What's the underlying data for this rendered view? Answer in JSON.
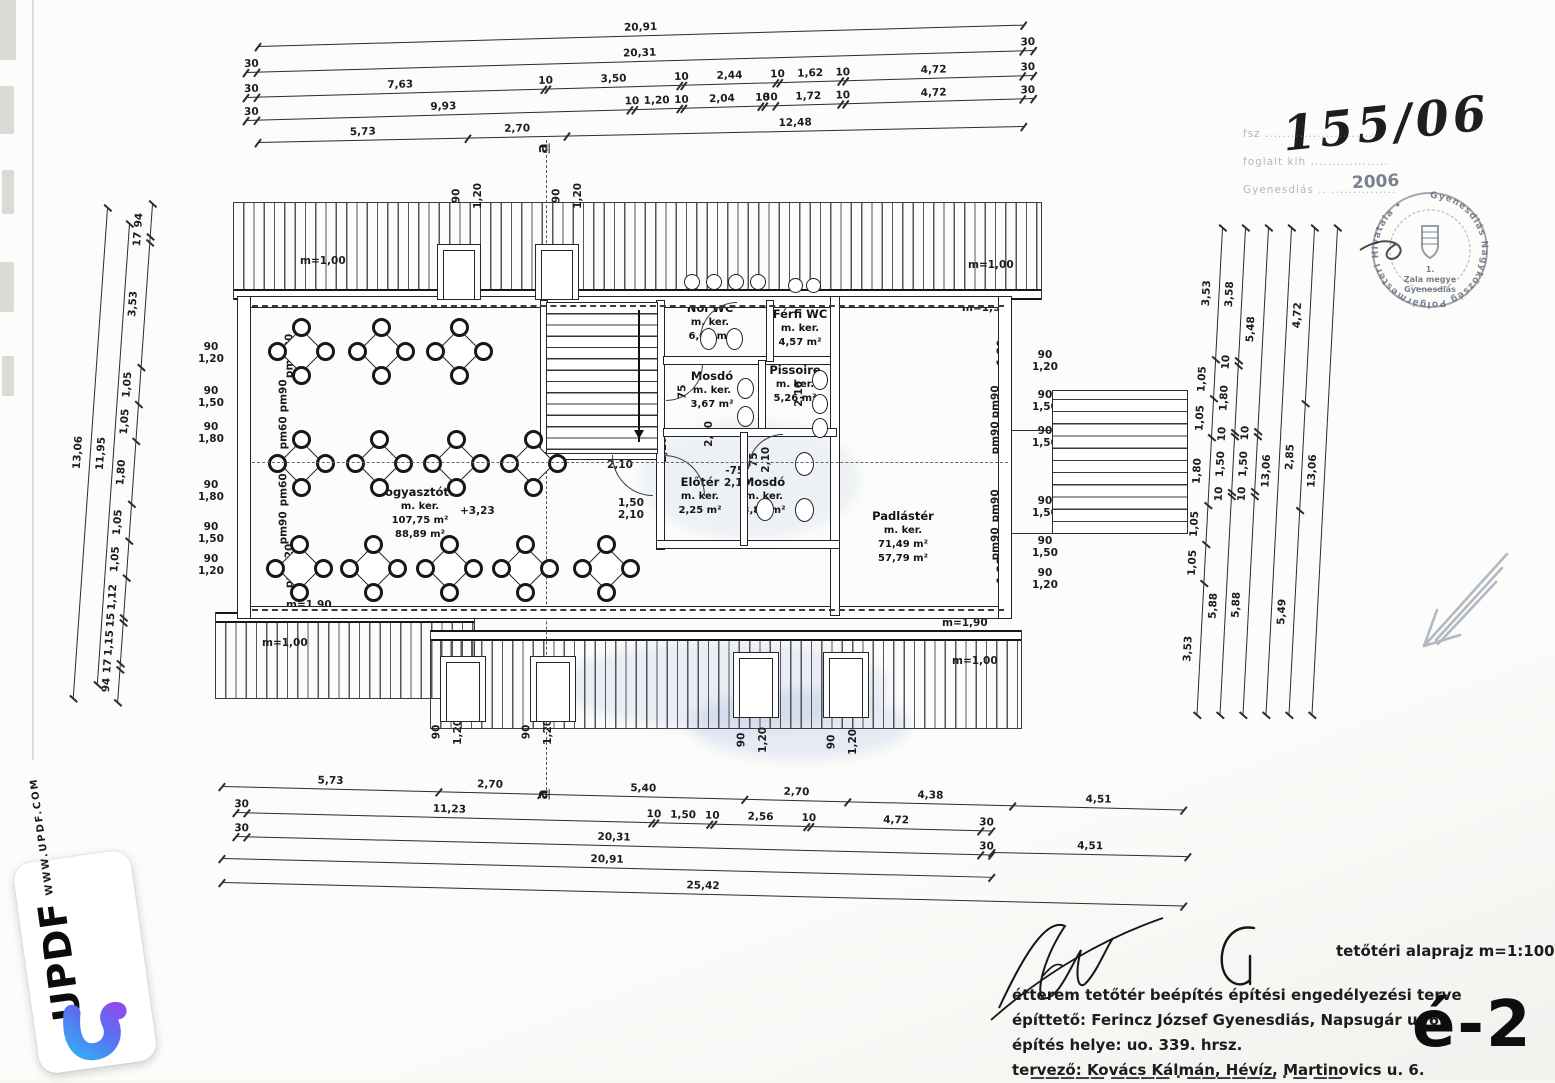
{
  "stamp": {
    "number": "155/06",
    "year": "2006",
    "ring_text": "Gyenesdiás Nagyközség Polgármesteri Hivatala •",
    "center_lines": [
      "1.",
      "Zala megye",
      "Gyenesdiás"
    ],
    "faint_lines": [
      "fsz ..........................",
      "foglalt kih ..................",
      "Gyenesdiás .. ..............."
    ]
  },
  "title_block": {
    "drawing_title": "tetőtéri alaprajz m=1:100",
    "project_lines": [
      "étterem tetőtér beépítés építési engedélyezési terve",
      "építtető: Ferincz József Gyenesdiás, Napsugár u. 6.",
      "építés helye: uo. 339. hrsz.",
      "tervező: Kovács Kálmán, Hévíz, Martinovics u. 6."
    ],
    "truncated_line": "—————  ————  · ——————  ·  — ——",
    "drawing_code": "é-2"
  },
  "watermark": {
    "brand": "UPDF",
    "url": "WWW.UPDF.COM"
  },
  "rooms": [
    {
      "x": 420,
      "y": 484,
      "lines": [
        "Fogyasztótér",
        "m. ker.",
        "107,75 m²",
        "88,89 m²"
      ]
    },
    {
      "x": 710,
      "y": 300,
      "lines": [
        "Női WC",
        "m. ker.",
        "6,07 m²"
      ]
    },
    {
      "x": 800,
      "y": 306,
      "lines": [
        "Férfi WC",
        "m. ker.",
        "4,57 m²"
      ]
    },
    {
      "x": 712,
      "y": 368,
      "lines": [
        "Mosdó",
        "m. ker.",
        "3,67 m²"
      ]
    },
    {
      "x": 795,
      "y": 362,
      "lines": [
        "Pissoire",
        "m. ker.",
        "5,26 m²"
      ]
    },
    {
      "x": 700,
      "y": 474,
      "lines": [
        "Előtér",
        "m. ker.",
        "2,25 m²"
      ]
    },
    {
      "x": 764,
      "y": 474,
      "lines": [
        "Mosdó",
        "m. ker.",
        "3,84 m²"
      ]
    },
    {
      "x": 903,
      "y": 508,
      "lines": [
        "Padlástér",
        "m. ker.",
        "71,49 m²",
        "57,79 m²"
      ]
    }
  ],
  "chains": [
    {
      "x": 258,
      "y": 46,
      "len": 766,
      "rot": -1.6,
      "labels": [
        "20,91"
      ]
    },
    {
      "x": 246,
      "y": 72,
      "len": 788,
      "rot": -1.6,
      "labels": [
        "30",
        "20,31",
        "30"
      ]
    },
    {
      "x": 246,
      "y": 97,
      "len": 788,
      "rot": -1.6,
      "labels": [
        "30",
        "7,63",
        "10",
        "3,50",
        "10",
        "2,44",
        "10",
        "1,62",
        "10",
        "4,72",
        "30"
      ]
    },
    {
      "x": 246,
      "y": 120,
      "len": 788,
      "rot": -1.6,
      "labels": [
        "30",
        "9,93",
        "10",
        "1,20",
        "10",
        "2,04",
        "10",
        "30",
        "1,72",
        "10",
        "4,72",
        "30"
      ]
    },
    {
      "x": 258,
      "y": 142,
      "len": 766,
      "rot": -1.2,
      "labels": [
        "5,73",
        "2,70",
        "12,48"
      ]
    },
    {
      "x": 222,
      "y": 786,
      "len": 962,
      "rot": 1.4,
      "labels": [
        "5,73",
        "2,70",
        "5,40",
        "2,70",
        "4,38",
        "4,51"
      ]
    },
    {
      "x": 236,
      "y": 812,
      "len": 756,
      "rot": 1.4,
      "labels": [
        "30",
        "11,23",
        "10",
        "1,50",
        "10",
        "2,56",
        "10",
        "4,72",
        "30"
      ]
    },
    {
      "x": 236,
      "y": 836,
      "len": 756,
      "rot": 1.4,
      "labels": [
        "30",
        "20,31",
        "30"
      ]
    },
    {
      "x": 222,
      "y": 858,
      "len": 770,
      "rot": 1.4,
      "labels": [
        "20,91"
      ]
    },
    {
      "x": 992,
      "y": 852,
      "len": 196,
      "rot": 1.2,
      "labels": [
        "4,51"
      ]
    },
    {
      "x": 222,
      "y": 882,
      "len": 962,
      "rot": 1.4,
      "labels": [
        "25,42"
      ]
    },
    {
      "v": 1,
      "x": 107,
      "y": 208,
      "len": 492,
      "rot": 4,
      "labels": [
        "13,06"
      ]
    },
    {
      "v": 1,
      "x": 129,
      "y": 224,
      "len": 462,
      "rot": 4,
      "labels": [
        "11,95"
      ]
    },
    {
      "v": 1,
      "x": 152,
      "y": 204,
      "len": 500,
      "rot": 4,
      "labels": [
        "94",
        "17",
        "3,53",
        "1,05",
        "1,05",
        "1,80",
        "1,05",
        "1,05",
        "1,12",
        "15",
        "1,15",
        "17",
        "94"
      ]
    },
    {
      "v": 1,
      "x": 1222,
      "y": 228,
      "len": 488,
      "rot": 3,
      "labels": [
        "3,53",
        "1,05",
        "1,05",
        "1,80",
        "1,05",
        "1,05",
        "3,53"
      ]
    },
    {
      "v": 1,
      "x": 1245,
      "y": 228,
      "len": 488,
      "rot": 3,
      "labels": [
        "3,58",
        "10",
        "1,80",
        "10",
        "1,50",
        "10",
        "5,88"
      ]
    },
    {
      "v": 1,
      "x": 1268,
      "y": 228,
      "len": 488,
      "rot": 3,
      "labels": [
        "5,48",
        "10",
        "1,50",
        "10",
        "5,88"
      ]
    },
    {
      "v": 1,
      "x": 1291,
      "y": 228,
      "len": 488,
      "rot": 3,
      "labels": [
        "13,06"
      ]
    },
    {
      "v": 1,
      "x": 1314,
      "y": 228,
      "len": 488,
      "rot": 3,
      "labels": [
        "4,72",
        "2,85",
        "5,49"
      ]
    },
    {
      "v": 1,
      "x": 1337,
      "y": 228,
      "len": 488,
      "rot": 3,
      "labels": [
        "13,06"
      ]
    }
  ],
  "annotations": [
    {
      "x": 300,
      "y": 256,
      "lines": [
        "m=1,00"
      ]
    },
    {
      "x": 968,
      "y": 260,
      "lines": [
        "m=1,00"
      ]
    },
    {
      "x": 262,
      "y": 638,
      "lines": [
        "m=1,00"
      ]
    },
    {
      "x": 952,
      "y": 656,
      "lines": [
        "m=1,00"
      ]
    },
    {
      "x": 286,
      "y": 298,
      "lines": [
        "m=1,90"
      ]
    },
    {
      "x": 962,
      "y": 303,
      "lines": [
        "m=1,90"
      ]
    },
    {
      "x": 286,
      "y": 600,
      "lines": [
        "m=1,90"
      ]
    },
    {
      "x": 942,
      "y": 618,
      "lines": [
        "m=1,90"
      ]
    },
    {
      "x": 268,
      "y": 350,
      "rot": -90,
      "lines": [
        "pm1,20"
      ]
    },
    {
      "x": 268,
      "y": 390,
      "rot": -90,
      "lines": [
        "pm90"
      ]
    },
    {
      "x": 268,
      "y": 427,
      "rot": -90,
      "lines": [
        "pm60"
      ]
    },
    {
      "x": 268,
      "y": 484,
      "rot": -90,
      "lines": [
        "pm60"
      ]
    },
    {
      "x": 268,
      "y": 522,
      "rot": -90,
      "lines": [
        "pm90"
      ]
    },
    {
      "x": 268,
      "y": 560,
      "rot": -90,
      "lines": [
        "pm1,20"
      ]
    },
    {
      "x": 980,
      "y": 356,
      "rot": -90,
      "lines": [
        "pm1,20"
      ]
    },
    {
      "x": 980,
      "y": 396,
      "rot": -90,
      "lines": [
        "pm90"
      ]
    },
    {
      "x": 980,
      "y": 432,
      "rot": -90,
      "lines": [
        "pm90"
      ]
    },
    {
      "x": 980,
      "y": 500,
      "rot": -90,
      "lines": [
        "pm90"
      ]
    },
    {
      "x": 980,
      "y": 538,
      "rot": -90,
      "lines": [
        "pm90"
      ]
    },
    {
      "x": 980,
      "y": 574,
      "rot": -90,
      "lines": [
        "pm1,20"
      ]
    },
    {
      "x": 198,
      "y": 342,
      "lines": [
        "90",
        "1,20"
      ]
    },
    {
      "x": 198,
      "y": 386,
      "lines": [
        "90",
        "1,50"
      ]
    },
    {
      "x": 198,
      "y": 422,
      "lines": [
        "90",
        "1,80"
      ]
    },
    {
      "x": 198,
      "y": 480,
      "lines": [
        "90",
        "1,80"
      ]
    },
    {
      "x": 198,
      "y": 522,
      "lines": [
        "90",
        "1,50"
      ]
    },
    {
      "x": 198,
      "y": 554,
      "lines": [
        "90",
        "1,20"
      ]
    },
    {
      "x": 1032,
      "y": 350,
      "lines": [
        "90",
        "1,20"
      ]
    },
    {
      "x": 1032,
      "y": 390,
      "lines": [
        "90",
        "1,50"
      ]
    },
    {
      "x": 1032,
      "y": 426,
      "lines": [
        "90",
        "1,50"
      ]
    },
    {
      "x": 1032,
      "y": 496,
      "lines": [
        "90",
        "1,50"
      ]
    },
    {
      "x": 1032,
      "y": 536,
      "lines": [
        "90",
        "1,50"
      ]
    },
    {
      "x": 1032,
      "y": 568,
      "lines": [
        "90",
        "1,20"
      ]
    },
    {
      "x": 450,
      "y": 190,
      "rot": -90,
      "lines": [
        "90"
      ]
    },
    {
      "x": 466,
      "y": 190,
      "rot": -90,
      "lines": [
        "1,20"
      ]
    },
    {
      "x": 550,
      "y": 190,
      "rot": -90,
      "lines": [
        "90"
      ]
    },
    {
      "x": 566,
      "y": 190,
      "rot": -90,
      "lines": [
        "1,20"
      ]
    },
    {
      "x": 430,
      "y": 726,
      "rot": -90,
      "lines": [
        "90"
      ]
    },
    {
      "x": 446,
      "y": 726,
      "rot": -90,
      "lines": [
        "1,20"
      ]
    },
    {
      "x": 520,
      "y": 726,
      "rot": -90,
      "lines": [
        "90"
      ]
    },
    {
      "x": 536,
      "y": 726,
      "rot": -90,
      "lines": [
        "1,20"
      ]
    },
    {
      "x": 735,
      "y": 734,
      "rot": -90,
      "lines": [
        "90"
      ]
    },
    {
      "x": 751,
      "y": 734,
      "rot": -90,
      "lines": [
        "1,20"
      ]
    },
    {
      "x": 825,
      "y": 736,
      "rot": -90,
      "lines": [
        "90"
      ]
    },
    {
      "x": 841,
      "y": 736,
      "rot": -90,
      "lines": [
        "1,20"
      ]
    },
    {
      "x": 626,
      "y": 310,
      "lines": [
        "+1,70"
      ]
    },
    {
      "x": 460,
      "y": 506,
      "lines": [
        "+3,23"
      ]
    },
    {
      "x": 607,
      "y": 448,
      "lines": [
        "90",
        "2,10"
      ]
    },
    {
      "x": 618,
      "y": 498,
      "lines": [
        "1,50",
        "2,10"
      ]
    },
    {
      "x": 645,
      "y": 438,
      "rot": -90,
      "lines": [
        "75",
        "2,10"
      ]
    },
    {
      "x": 724,
      "y": 466,
      "lines": [
        "-75-",
        "2,10"
      ]
    },
    {
      "x": 748,
      "y": 448,
      "rot": -90,
      "lines": [
        "75",
        "2,10"
      ]
    },
    {
      "x": 697,
      "y": 428,
      "rot": -90,
      "lines": [
        "2,10"
      ]
    },
    {
      "x": 787,
      "y": 388,
      "rot": -90,
      "lines": [
        "2,10"
      ]
    },
    {
      "x": 676,
      "y": 386,
      "rot": -90,
      "lines": [
        "75"
      ]
    },
    {
      "x": 538,
      "y": 140,
      "rot": -90,
      "cls": "sec",
      "lines": [
        "a"
      ]
    },
    {
      "x": 538,
      "y": 786,
      "rot": -90,
      "cls": "sec",
      "lines": [
        "a"
      ]
    }
  ],
  "plan": {
    "tables": [
      [
        300,
        350
      ],
      [
        380,
        350
      ],
      [
        458,
        350
      ],
      [
        300,
        462
      ],
      [
        378,
        462
      ],
      [
        455,
        462
      ],
      [
        532,
        462
      ],
      [
        298,
        567
      ],
      [
        372,
        567
      ],
      [
        448,
        567
      ],
      [
        524,
        567
      ],
      [
        605,
        567
      ]
    ]
  }
}
